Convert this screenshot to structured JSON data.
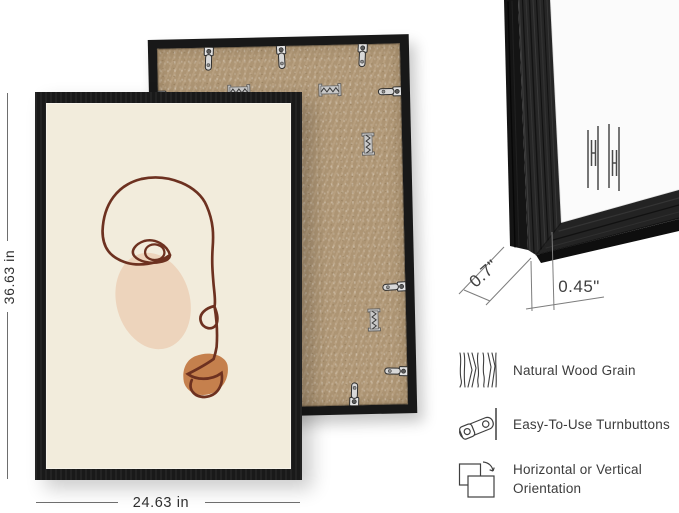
{
  "product": {
    "front_dimension_height": "36.63 in",
    "front_dimension_width": "24.63 in"
  },
  "corner_detail": {
    "depth_label": "0.7\"",
    "face_width_label": "0.45\""
  },
  "features": [
    {
      "icon": "wood-grain-icon",
      "label": "Natural Wood Grain"
    },
    {
      "icon": "turnbutton-icon",
      "label": "Easy-To-Use Turnbuttons"
    },
    {
      "icon": "orientation-icon",
      "label": "Horizontal or Vertical Orientation"
    }
  ],
  "icons": {
    "wood_grain": "wood-grain-icon",
    "turnbutton": "turnbutton-icon",
    "orientation": "orientation-icon",
    "brand_watermark": "brand-watermark-icon",
    "sawtooth_hanger": "sawtooth-hanger-icon"
  },
  "colors": {
    "frame": "#191919",
    "poster_background": "#f2ecdc",
    "line_art": "#6d3120",
    "cheek_blob": "#edd4bc",
    "lips_blob": "#c5804d",
    "mdf_backing": "#b39a78",
    "annotation_text": "#3d3d3d"
  }
}
